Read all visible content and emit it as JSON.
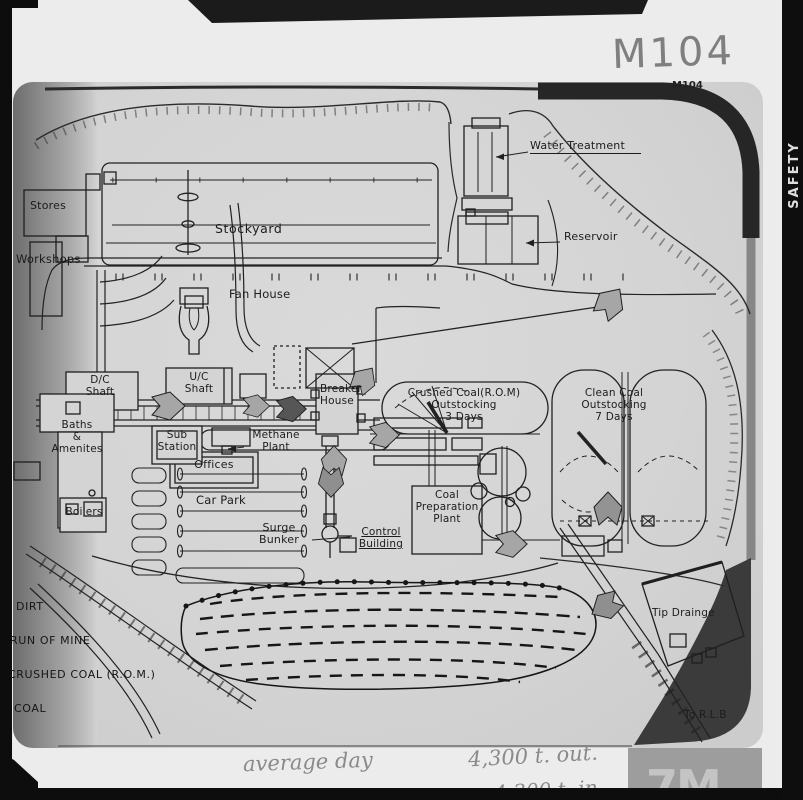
{
  "film": {
    "edge_text": "SAFETY FILM",
    "handwritten_ref": "M104",
    "watermark_logo": "7M",
    "annotations": {
      "line1_left": "average day",
      "line1_right": "4,300 t. out.",
      "line2": "4,300 t. in"
    }
  },
  "map": {
    "sheet_ref": "M104",
    "labels": {
      "stockyard": "Stockyard",
      "stores": "Stores",
      "workshops": "Workshops",
      "water_treatment": "Water Treatment",
      "reservoir": "Reservoir",
      "fan_house": "Fan House",
      "dc_shaft": "D/C\nShaft",
      "uc_shaft": "U/C\nShaft",
      "breaker_house": "Breaker\nHouse",
      "baths_amenities": "Baths\n&\nAmenites",
      "offices": "Offices",
      "sub_station": "Sub\nStation",
      "methane_plant": "Methane\nPlant",
      "boilers": "Boilers",
      "car_park": "Car Park",
      "surge_bunker": "Surge\nBunker",
      "control_building": "Control\nBuilding",
      "coal_prep_plant": "Coal\nPreparation\nPlant",
      "crushed_outstocking": "Crushed Coal(R.O.M)\nOutstocking\n3 Days",
      "clean_outstocking": "Clean Coal\nOutstocking\n7 Days",
      "tip_drainage": "Tip Drainge",
      "to_rlb": "To R.L.B"
    },
    "legend": {
      "items": [
        "DIRT",
        "RUN OF MINE",
        "CRUSHED COAL (R.O.M.)",
        "COAL"
      ]
    },
    "colors": {
      "paper": "#ececec",
      "drawing_bg": "#d4d4d4",
      "ink": "#1f1f1f",
      "arrow_mid": "#a6a6a6",
      "arrow_dark": "#565656",
      "frame_dark": "#262626"
    }
  }
}
